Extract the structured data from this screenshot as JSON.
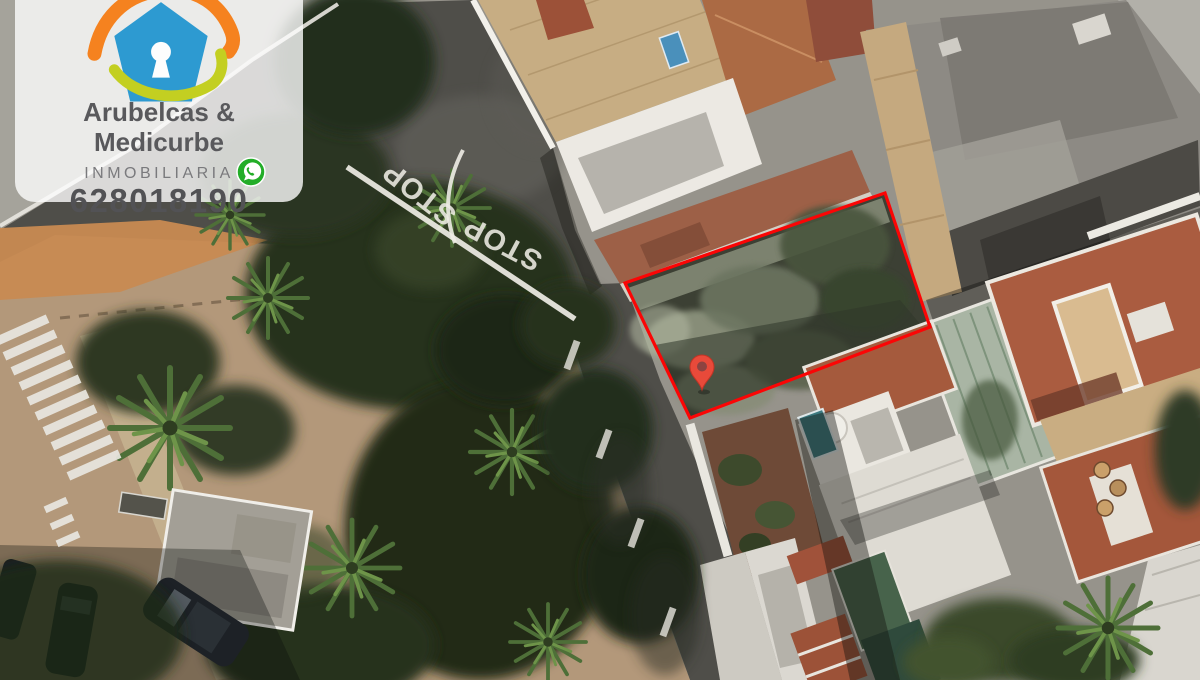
{
  "brand_card": {
    "name": "Arubelcas & Medicurbe",
    "subtitle": "INMOBILIARIA",
    "phone": "628018190",
    "logo_icon": "house-with-keyhole",
    "logo_colors": {
      "roof": "#f5821f",
      "house": "#2d9ad1",
      "swoosh": "#c3cf21"
    },
    "whatsapp_icon": "whatsapp",
    "whatsapp_color": "#23ad28",
    "text_color": "#59595c"
  },
  "satellite_view": {
    "type": "aerial-satellite-photo",
    "road_markings": {
      "stop_label": "STOP",
      "paint_color": "#eeece5"
    },
    "parcel": {
      "boundary_color": "#fb0505",
      "pin_icon": "map-pin",
      "pin_color": "#e84a3a"
    }
  }
}
